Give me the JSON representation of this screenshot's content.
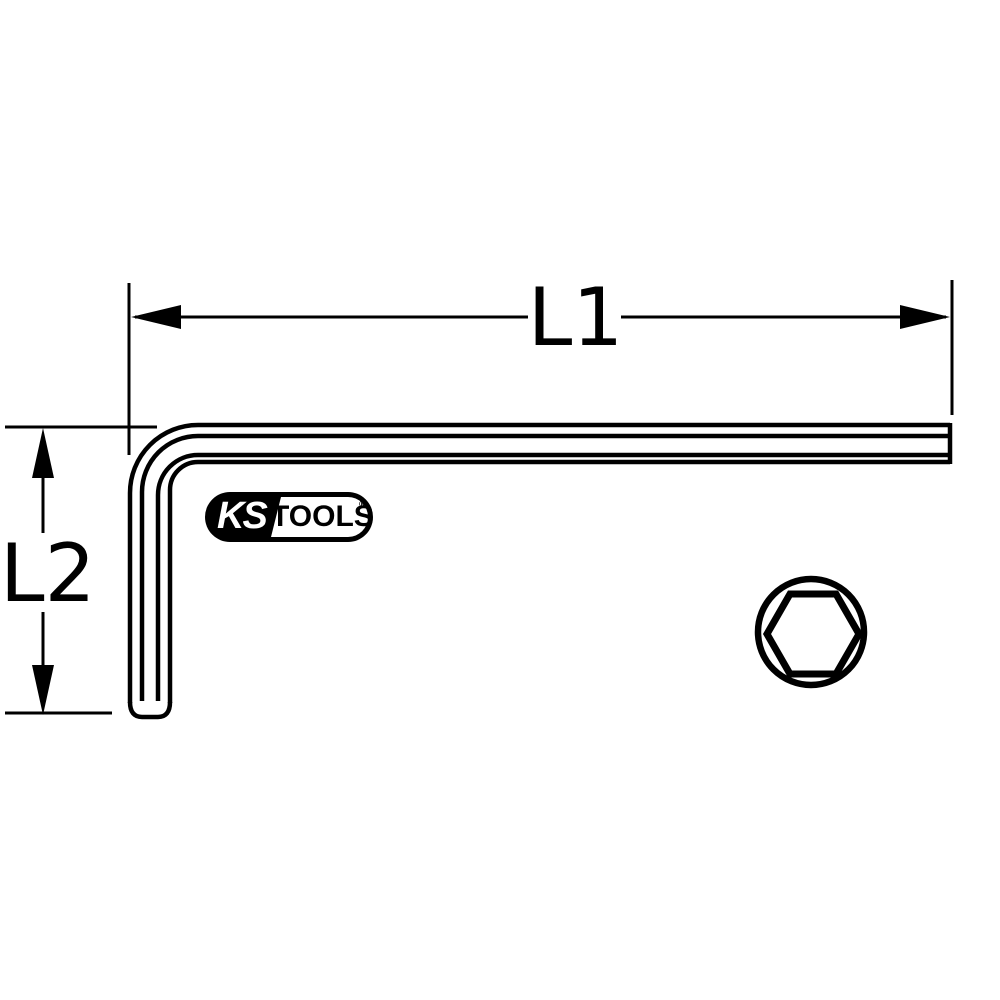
{
  "drawing": {
    "title_hint": "hex-key-technical-drawing",
    "colors": {
      "line": "#000000",
      "background": "#ffffff"
    },
    "dimensions": {
      "l1": "L1",
      "l2": "L2"
    },
    "logo": {
      "ks": "KS",
      "tools": "TOOLS",
      "registered": "®"
    }
  }
}
